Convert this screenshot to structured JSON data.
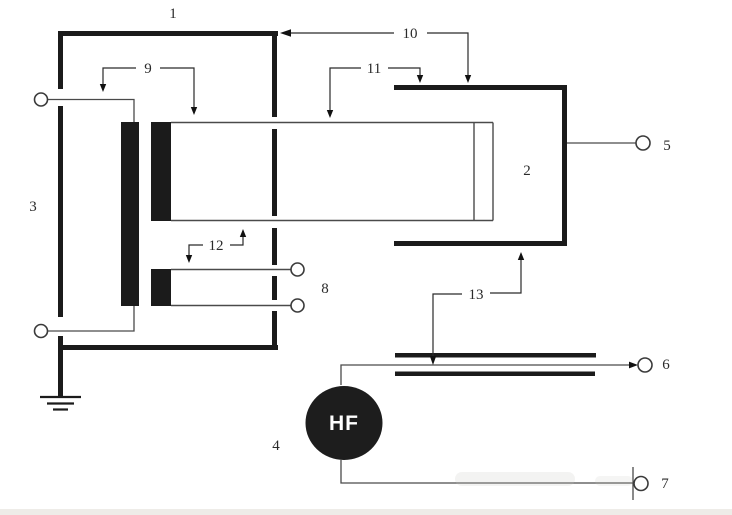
{
  "diagram": {
    "description_labels": {
      "p1": "1",
      "p2": "2",
      "p3": "3",
      "p4": "4",
      "p5": "5",
      "p6": "6",
      "p7": "7",
      "p8": "8",
      "p9": "9",
      "p10": "10",
      "p11": "11",
      "p12": "12",
      "p13": "13"
    },
    "hf_source": {
      "label": "HF"
    },
    "colors": {
      "background": "#ffffff",
      "thick_line": "#1b1b1b",
      "thin_line": "#4a4a4a",
      "label_text": "#2a2a2a",
      "hf_fill": "#1d1d1d",
      "hf_text": "#ffffff",
      "bottom_shade": "#eceae6"
    }
  }
}
